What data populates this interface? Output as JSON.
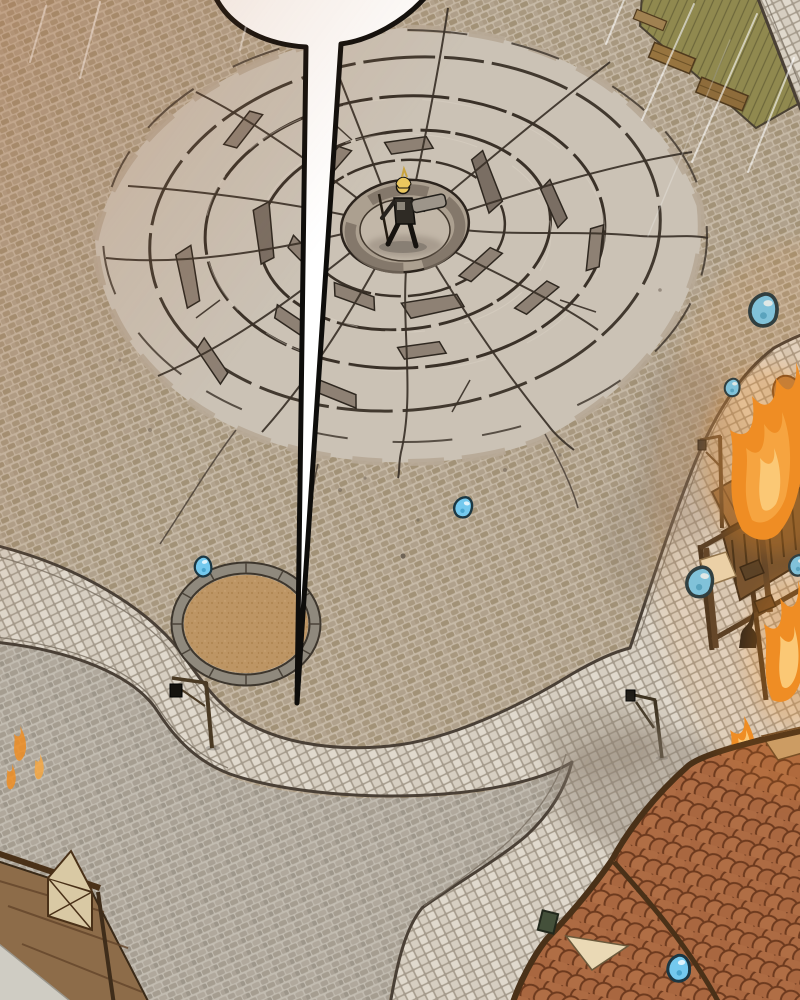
{
  "scene": {
    "medium": "webtoon comic panel",
    "view": "isometric aerial view of a town square",
    "description": "A blonde armored figure stands at the center of a huge cracked impact crater in a cobblestone plaza. A long empty speech-bubble tail points down from off-panel to the figure. Light stone streets curve past a round dirt planter, lamp posts, a burning wooden market stall, drifting smoke, scattered blue gem drops, green mats with benches, a wooden fence, and terracotta fish-scale rooftops.",
    "visible_text": ""
  },
  "colors": {
    "plaza_brown_base": "#b7a896",
    "plaza_gray_base": "#b3aca0",
    "street_tile": "#e0d9cd",
    "street_border": "#4a4036",
    "crater_surface": "#cbc2b5",
    "crater_pit": "#aca090",
    "crater_pit_floor": "#c2b7a8",
    "crater_crack": "#3a3128",
    "crater_slab_shadow": "#8e8174",
    "speech_bubble_fill": "#ffffff",
    "speech_bubble_outline": "#0e0d0b",
    "dirt_patch": "#bd9564",
    "dirt_ring": "#8f897d",
    "gem_blue": "#74c9ee",
    "gem_outline": "#1b3743",
    "fire_orange": "#ef8e24",
    "fire_mid": "#f6a843",
    "fire_light": "#fcd07e",
    "smoke_gray": "#8b7f71",
    "roof_terracotta": "#a6613a",
    "roof_beam": "#4a3118",
    "stall_wood": "#8a6642",
    "wood_dark": "#3f2f1e",
    "mat_olive": "#90894f",
    "flag_beige": "#ead9b5",
    "hair_blonde": "#eac75e",
    "armor_dark": "#2f2b25",
    "weapon_gray": "#9d958a",
    "cat_black": "#201d18",
    "warm_tint": "#b56e3e"
  },
  "character": {
    "transform": "translate(403,246)",
    "pose": "standing at crater center"
  },
  "speech_bubble": {
    "tail_tip_x": 297,
    "tail_tip_y": 703
  },
  "gems": [
    {
      "transform": "translate(765,311) scale(1.55)"
    },
    {
      "transform": "translate(733,388) scale(0.85)"
    },
    {
      "transform": "translate(464,508) rotate(10)"
    },
    {
      "transform": "translate(204,567) scale(0.95) rotate(-14)"
    },
    {
      "transform": "translate(701,583) scale(1.45) rotate(6)"
    },
    {
      "transform": "translate(799,566)"
    },
    {
      "transform": "translate(680,969) scale(1.25) rotate(-8)"
    }
  ],
  "counts": {
    "gem_drops": 7,
    "lamp_posts": 3,
    "fires": 4
  }
}
